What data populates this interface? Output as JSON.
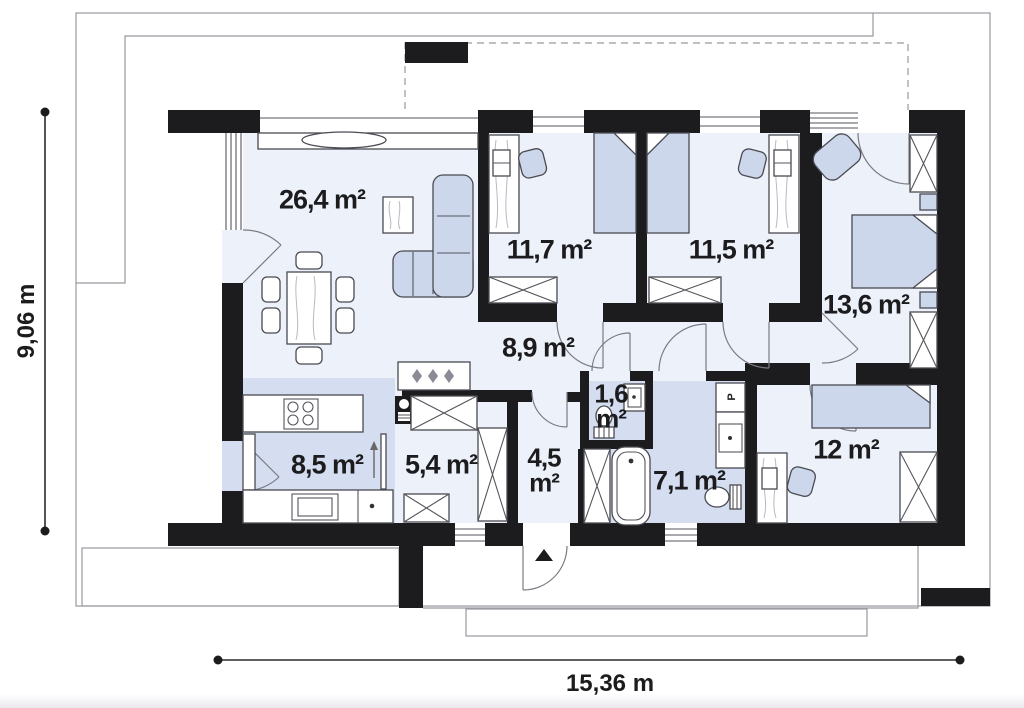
{
  "rooms": [
    {
      "id": "living-room",
      "area": "26,4 m²"
    },
    {
      "id": "bedroom-1",
      "area": "11,7 m²"
    },
    {
      "id": "bedroom-2",
      "area": "11,5 m²"
    },
    {
      "id": "bedroom-3",
      "area": "13,6 m²"
    },
    {
      "id": "hallway",
      "area": "8,9 m²"
    },
    {
      "id": "wc",
      "value": "1,6",
      "unit": "m²"
    },
    {
      "id": "kitchen",
      "area": "8,5 m²"
    },
    {
      "id": "storage",
      "area": "5,4 m²"
    },
    {
      "id": "entry",
      "value": "4,5",
      "unit": "m²"
    },
    {
      "id": "bathroom",
      "area": "7,1 m²"
    },
    {
      "id": "bedroom-4",
      "area": "12 m²"
    }
  ],
  "dimensions": {
    "width": "15,36 m",
    "height": "9,06 m"
  },
  "fixtures": {
    "washing_machine_label": "P"
  },
  "icons": {
    "entrance_arrow": "triangle-up",
    "hanger": "diamond"
  },
  "furniture": [
    "corner-sofa",
    "dining-table",
    "side-table",
    "single-bed",
    "double-bed",
    "desk",
    "office-chair",
    "armchair",
    "wardrobe",
    "kitchen-counter",
    "cooktop",
    "oven",
    "sink",
    "fridge",
    "bathtub",
    "toilet",
    "washing-machine",
    "night-stand"
  ],
  "colors": {
    "wall": "#1c1c1e",
    "floor": "#edf1f9",
    "tint": "#d5ddf0",
    "furniture": "#cdd7ec",
    "outline": "#4a4a52",
    "site_line": "#9a9aa0",
    "text": "#1c1c1e"
  }
}
